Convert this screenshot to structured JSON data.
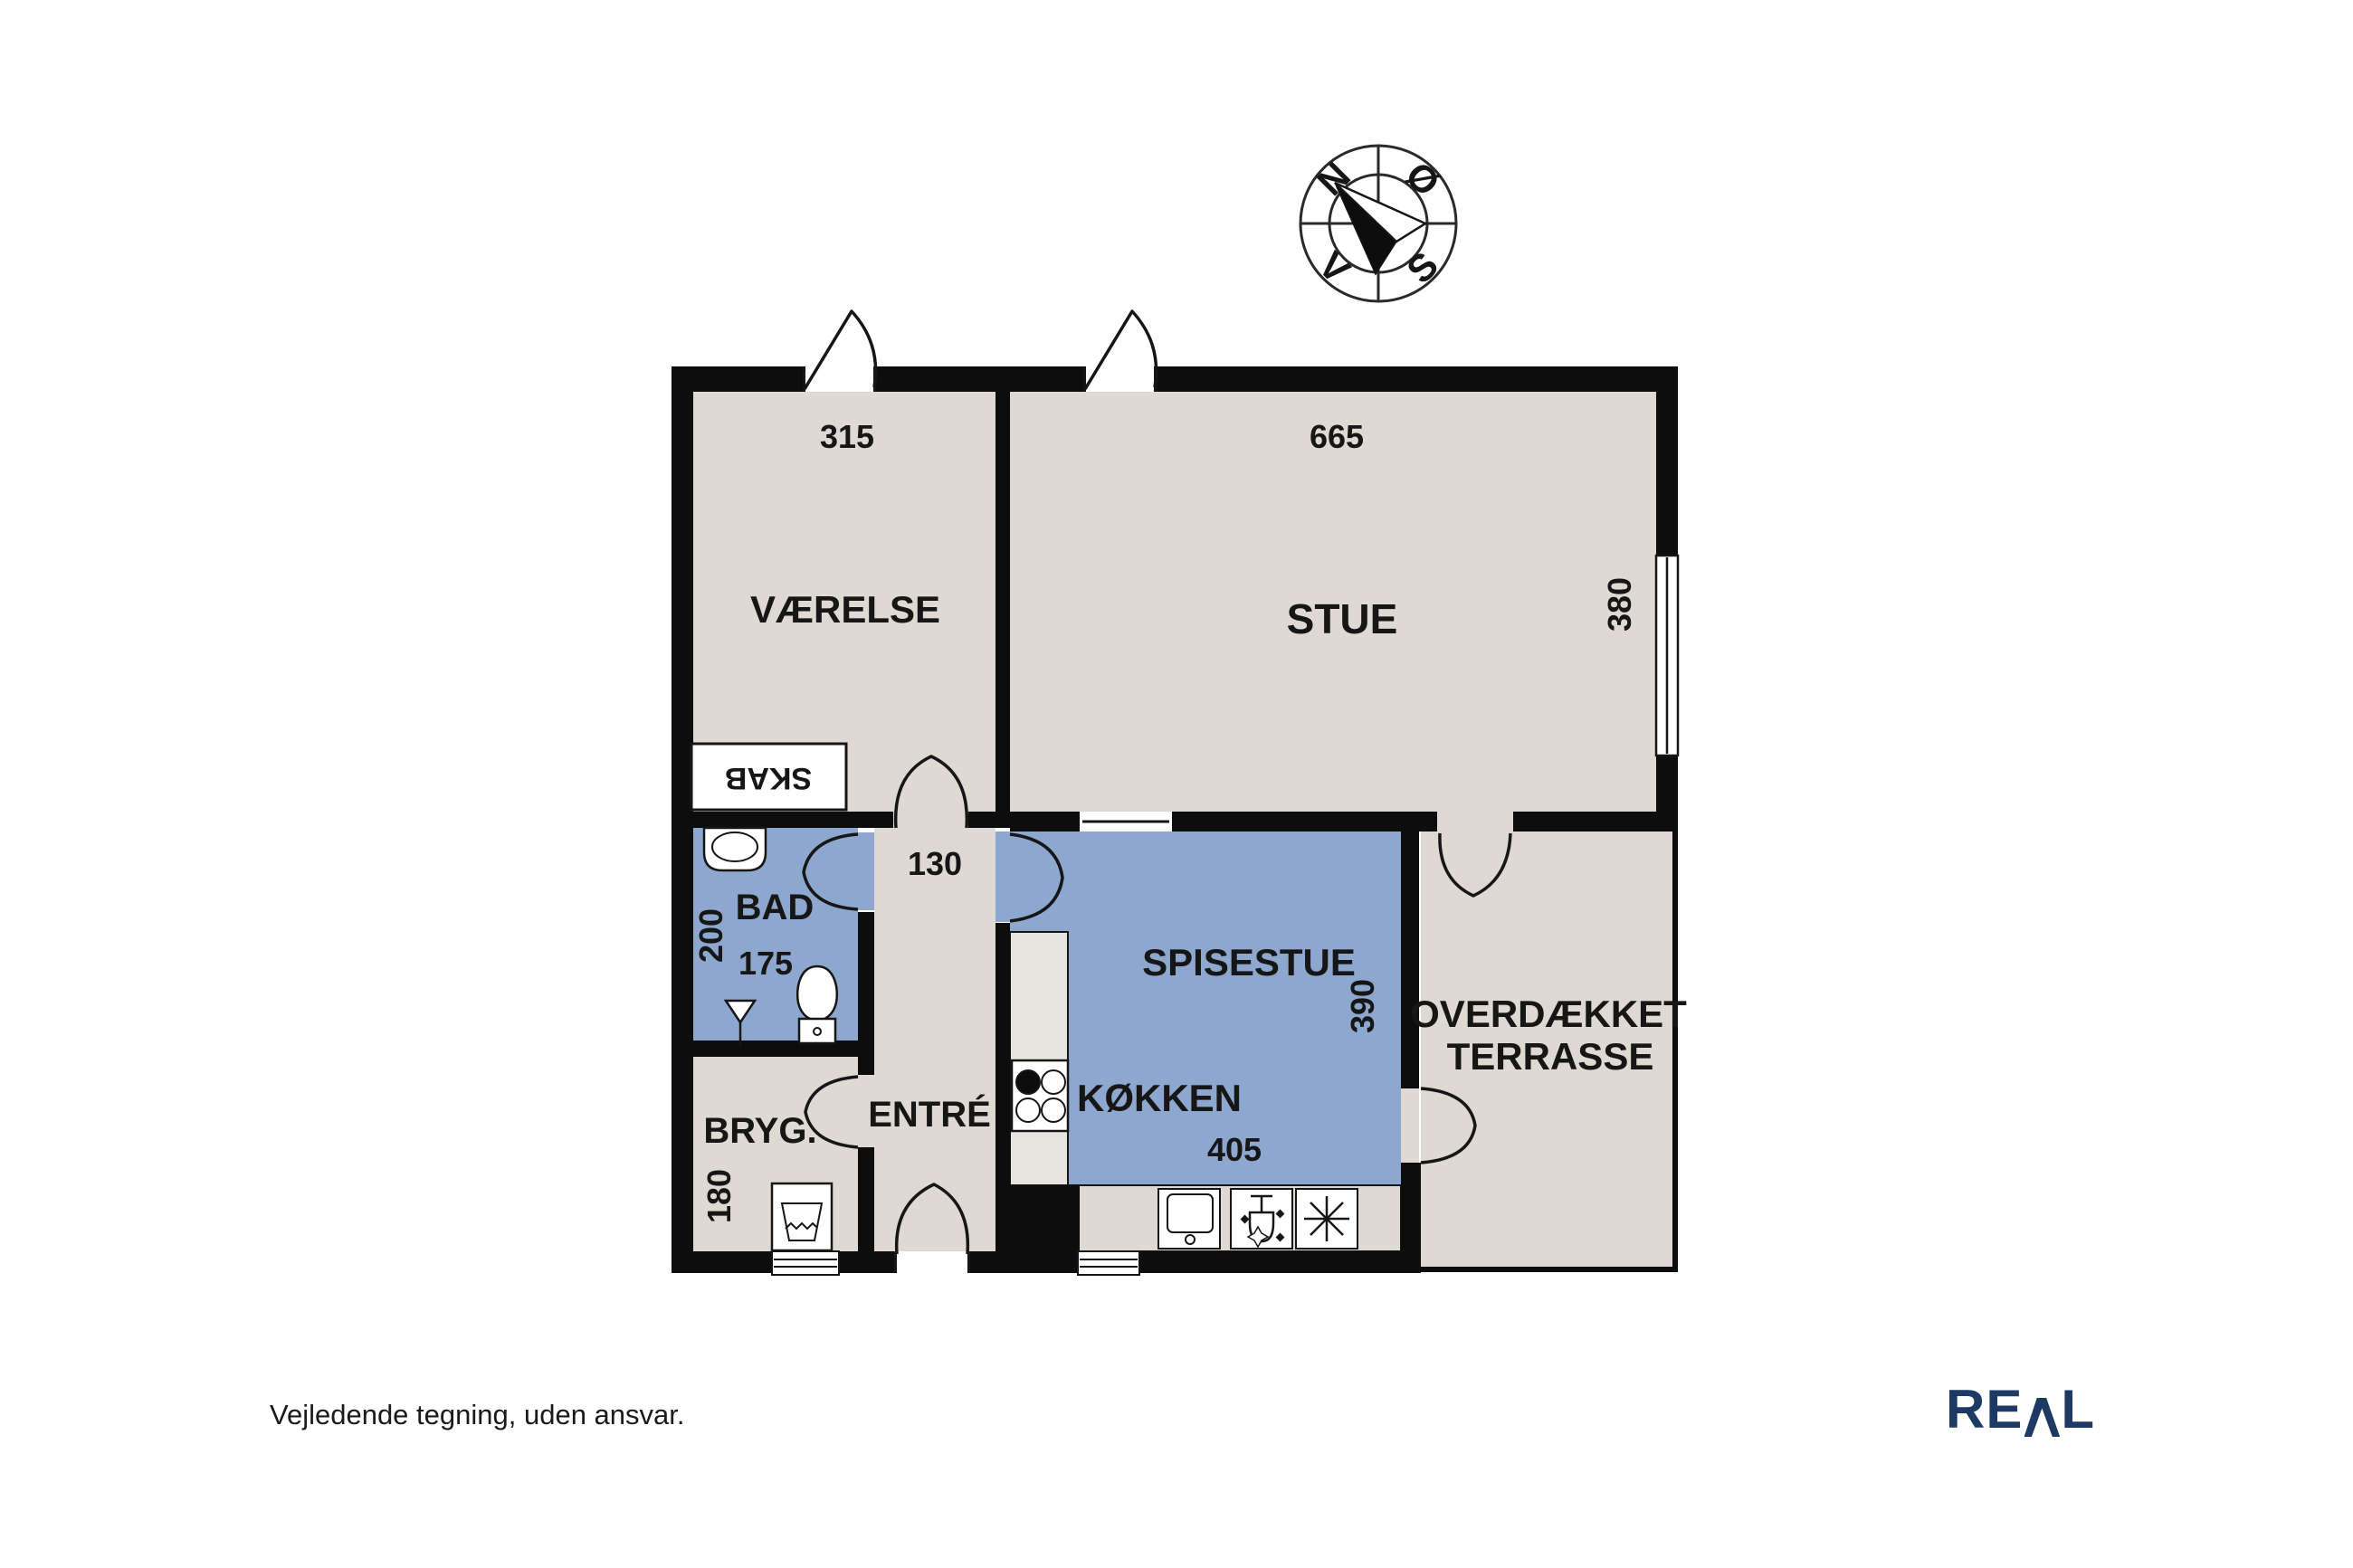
{
  "plan": {
    "compass": {
      "n": "N",
      "e": "Ø",
      "s": "S",
      "w": "V"
    },
    "rooms": {
      "vaerelse": {
        "label": "VÆRELSE",
        "width": "315"
      },
      "stue": {
        "label": "STUE",
        "width": "665",
        "depth": "380"
      },
      "skab": {
        "label": "SKAB"
      },
      "bad": {
        "label": "BAD",
        "depth": "200",
        "width": "175"
      },
      "entre": {
        "label": "ENTRÉ",
        "hall_width": "130"
      },
      "bryg": {
        "label": "BRYG.",
        "depth": "180"
      },
      "spisestue": {
        "label": "SPISESTUE",
        "depth": "390"
      },
      "koekken": {
        "label": "KØKKEN",
        "width": "405"
      },
      "terrasse": {
        "line1": "OVERDÆKKET",
        "line2": "TERRASSE"
      }
    },
    "colors": {
      "floor": "#ded9d2",
      "wet_room": "#8da7ce",
      "wall": "#0d0d0d",
      "counter": "#e7e4de",
      "logo_navy": "#1c3a63"
    }
  },
  "footer": {
    "disclaimer": "Vejledende tegning, uden ansvar.",
    "brand": "REAL",
    "brand_re": "RE",
    "brand_l": "L"
  }
}
